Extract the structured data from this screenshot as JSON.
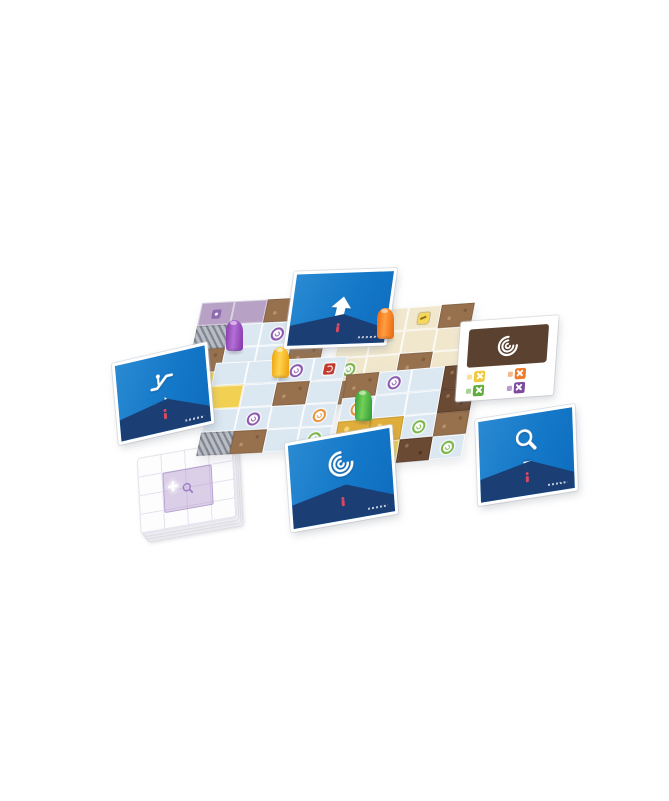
{
  "palette": {
    "background": "#ffffff",
    "card_blue": "#1478c8",
    "card_navy": "#1b3e74",
    "card_frame": "#ffffff",
    "arrow_white": "#ffffff",
    "figure_red": "#d94a62",
    "tile_light_floor": "#dbe7f1",
    "tile_beige_floor": "#f0e7cd",
    "tile_mauve_floor": "#b7a2c6",
    "tile_wall_dark": "#6b4a33",
    "tile_wall_brown": "#97714e",
    "tile_yellow_space": "#f2d152",
    "tile_gold_treasure": "#e0ae3a",
    "escalator_gray": "#b9bec6",
    "reference_panel_brown": "#5a4130",
    "stack_pattern_purple": "#ac8eca"
  },
  "cards": {
    "north": {
      "icons": [
        "arrow-up-icon"
      ]
    },
    "west": {
      "icons": [
        "escalator-icon",
        "arrow-right-icon"
      ]
    },
    "south": {
      "icons": [
        "vortex-icon",
        "arrow-left-icon"
      ]
    },
    "east": {
      "icons": [
        "magnifier-icon",
        "arrow-down-icon"
      ]
    }
  },
  "reference_card": {
    "main_icon": "vortex-icon",
    "panel_color": "#5a4130",
    "items": [
      {
        "name": "yellow-item",
        "hex": "#f0c93f"
      },
      {
        "name": "orange-item",
        "hex": "#ed7d2b"
      },
      {
        "name": "green-item",
        "hex": "#63ad3f"
      },
      {
        "name": "purple-item",
        "hex": "#7d4a9e"
      }
    ]
  },
  "tiles": {
    "grid_size": 4,
    "legend": {
      "L": "light floor",
      "E": "beige floor",
      "M": "mauve floor",
      "B": "dark wall",
      "b": "brown wall",
      "Y": "yellow space",
      "G": "gold treasure",
      "S": "escalator",
      "p": "purple swirl",
      "g": "green swirl",
      "o": "orange swirl",
      "r": "red item",
      "y": "yellow item",
      "q": "purple chip"
    },
    "northwest": [
      "M:q",
      "M",
      "b",
      "B",
      "S",
      "L",
      "L:p",
      "B",
      "b",
      "L",
      "L",
      "b",
      "Y",
      "L",
      "L:p",
      "b"
    ],
    "northeast": [
      "B",
      "E",
      "E:y",
      "b",
      "E",
      "E",
      "E",
      "E",
      "E:g",
      "E",
      "b",
      "E",
      "b",
      "E:r",
      "E",
      "E:q"
    ],
    "southwest": [
      "L",
      "L",
      "L:p",
      "L:r",
      "Y",
      "L",
      "b",
      "L",
      "L",
      "L:p",
      "L",
      "L:o",
      "S",
      "b",
      "L",
      "L:g"
    ],
    "southeast": [
      "b",
      "L:p",
      "L",
      "B",
      "L:o",
      "L",
      "L",
      "B",
      "G",
      "G",
      "L:g",
      "b",
      "G",
      "Y:q",
      "B",
      "L:g"
    ]
  },
  "pawns": [
    {
      "name": "purple-pawn",
      "dark": "#8a3fb0",
      "light": "#b46fd6",
      "x": 226,
      "y": 320
    },
    {
      "name": "yellow-pawn",
      "dark": "#f0a713",
      "light": "#ffd34d",
      "x": 272,
      "y": 347
    },
    {
      "name": "orange-pawn",
      "dark": "#ee6f12",
      "light": "#ff9d42",
      "x": 377,
      "y": 308
    },
    {
      "name": "green-pawn",
      "dark": "#3aa23a",
      "light": "#73d058",
      "x": 355,
      "y": 390
    }
  ],
  "tile_stack": {
    "visible_sheets": 4,
    "back_pattern_icon": "magnifier-icon",
    "sparkle_icon": "sparkle-icon"
  }
}
